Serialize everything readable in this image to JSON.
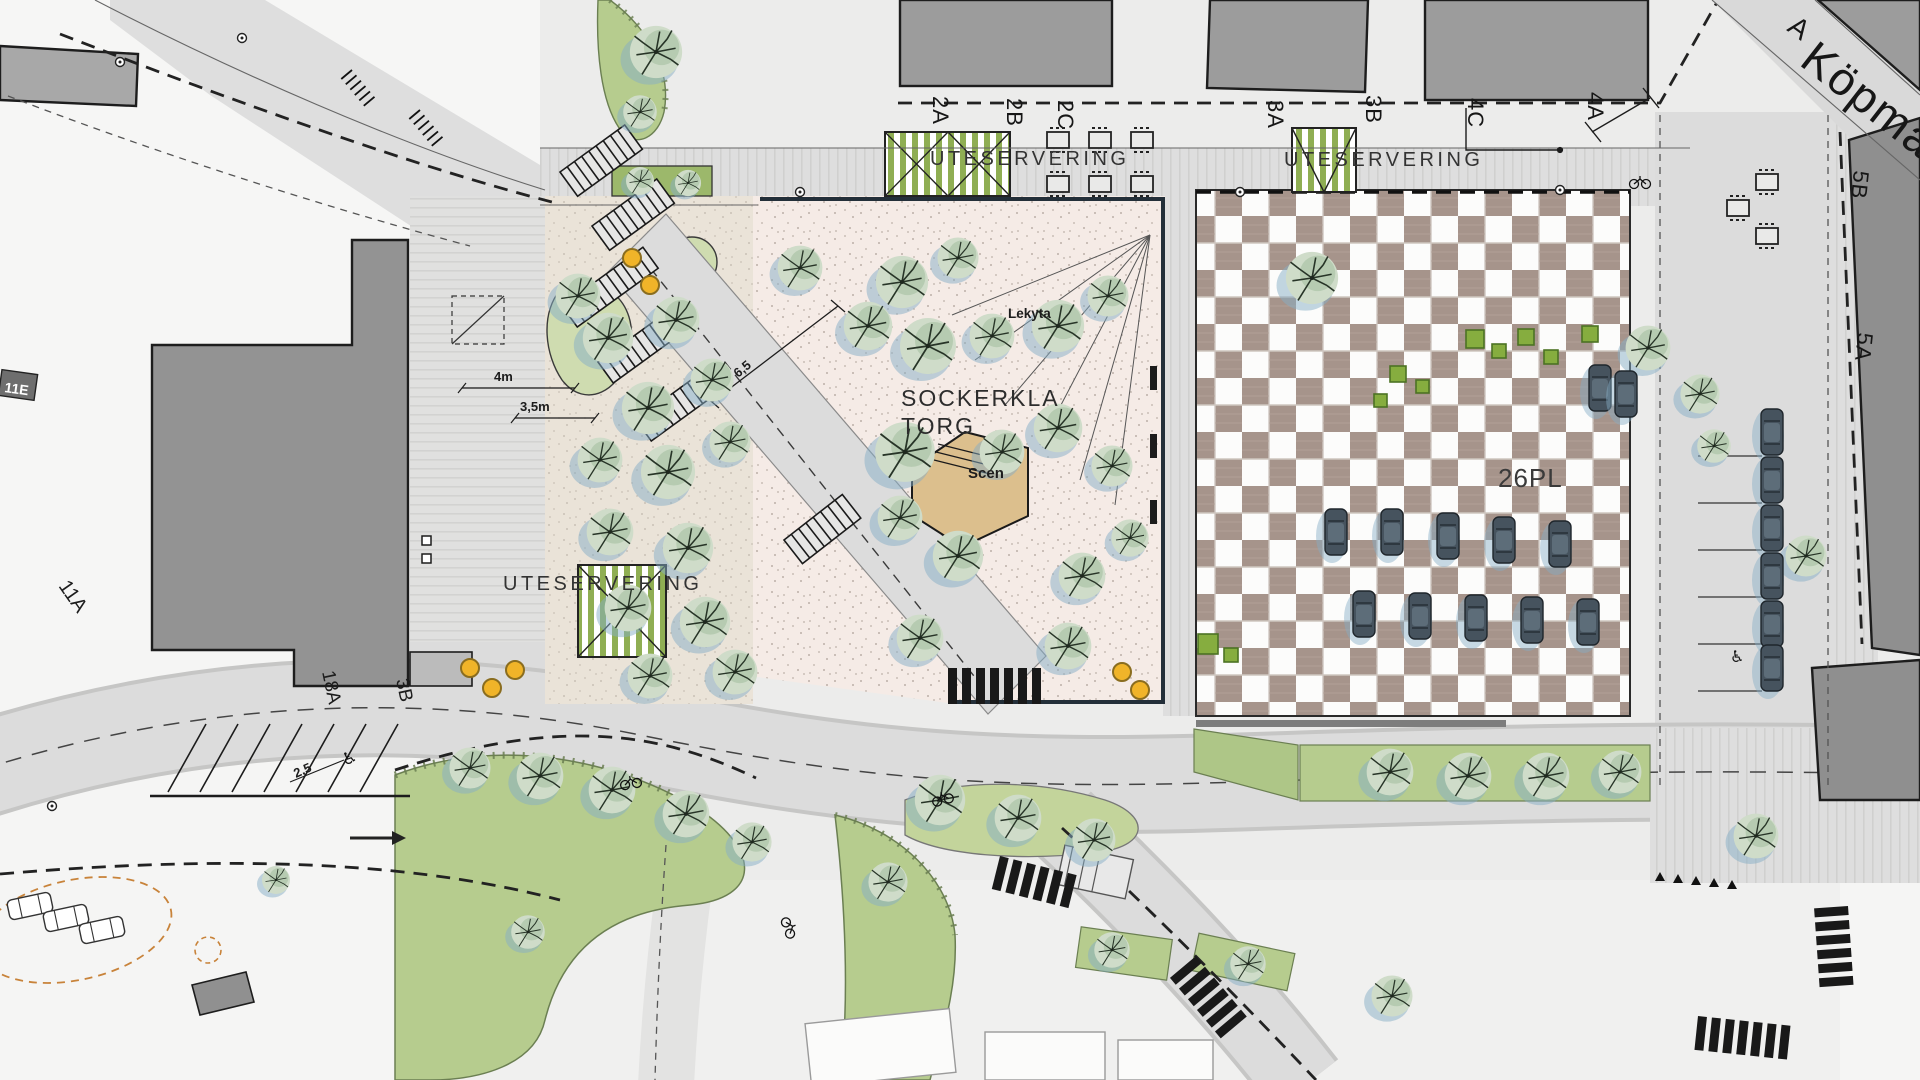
{
  "plan": {
    "street_name": "Köpma",
    "partial_label": "A",
    "plaza": {
      "name_line1": "SOCKERKLA",
      "name_line2": "TORG",
      "stage": "Scen",
      "play_area": "Lekyta"
    },
    "parking": {
      "capacity": "26PL",
      "stall_width": "2,5"
    },
    "outdoor_seating": {
      "label1": "UTESERVERING",
      "label2": "UTESERVERING",
      "label3": "UTESERVERING"
    },
    "buildings": {
      "b2a": "2A",
      "b2b": "2B",
      "b2c": "2C",
      "b3a": "3A",
      "b3b": "3B",
      "b4c": "4C",
      "b4a": "4A",
      "b5b": "5B",
      "b5a": "5A",
      "b11e": "11E",
      "b11a": "11A",
      "b18a": "18A",
      "b3b2": "3B"
    },
    "dimensions": {
      "d4m": "4m",
      "d35m": "3,5m",
      "d65": "6,5",
      "d25": "2,5"
    },
    "icons": {
      "wheelchair": "♿"
    },
    "colors": {
      "road": "#dcdcdc",
      "paving_stripe": "#d0d0cf",
      "building": "#9c9c9c",
      "building_dark": "#8f8f8f",
      "checker_taupe": "#a6948b",
      "plaza_pink": "#f5ebe6",
      "planting_gravel": "#eae3d8",
      "stage_tan": "#dcbf8d",
      "green_area": "#b6cc8e",
      "green_stripe": "#8fae53",
      "tree_canopy": "#cfdcc9",
      "tree_shadow": "#86aec5",
      "car_body": "#46535e",
      "accent_yellow": "#f0b429",
      "accent_orange": "#c8833a"
    }
  }
}
